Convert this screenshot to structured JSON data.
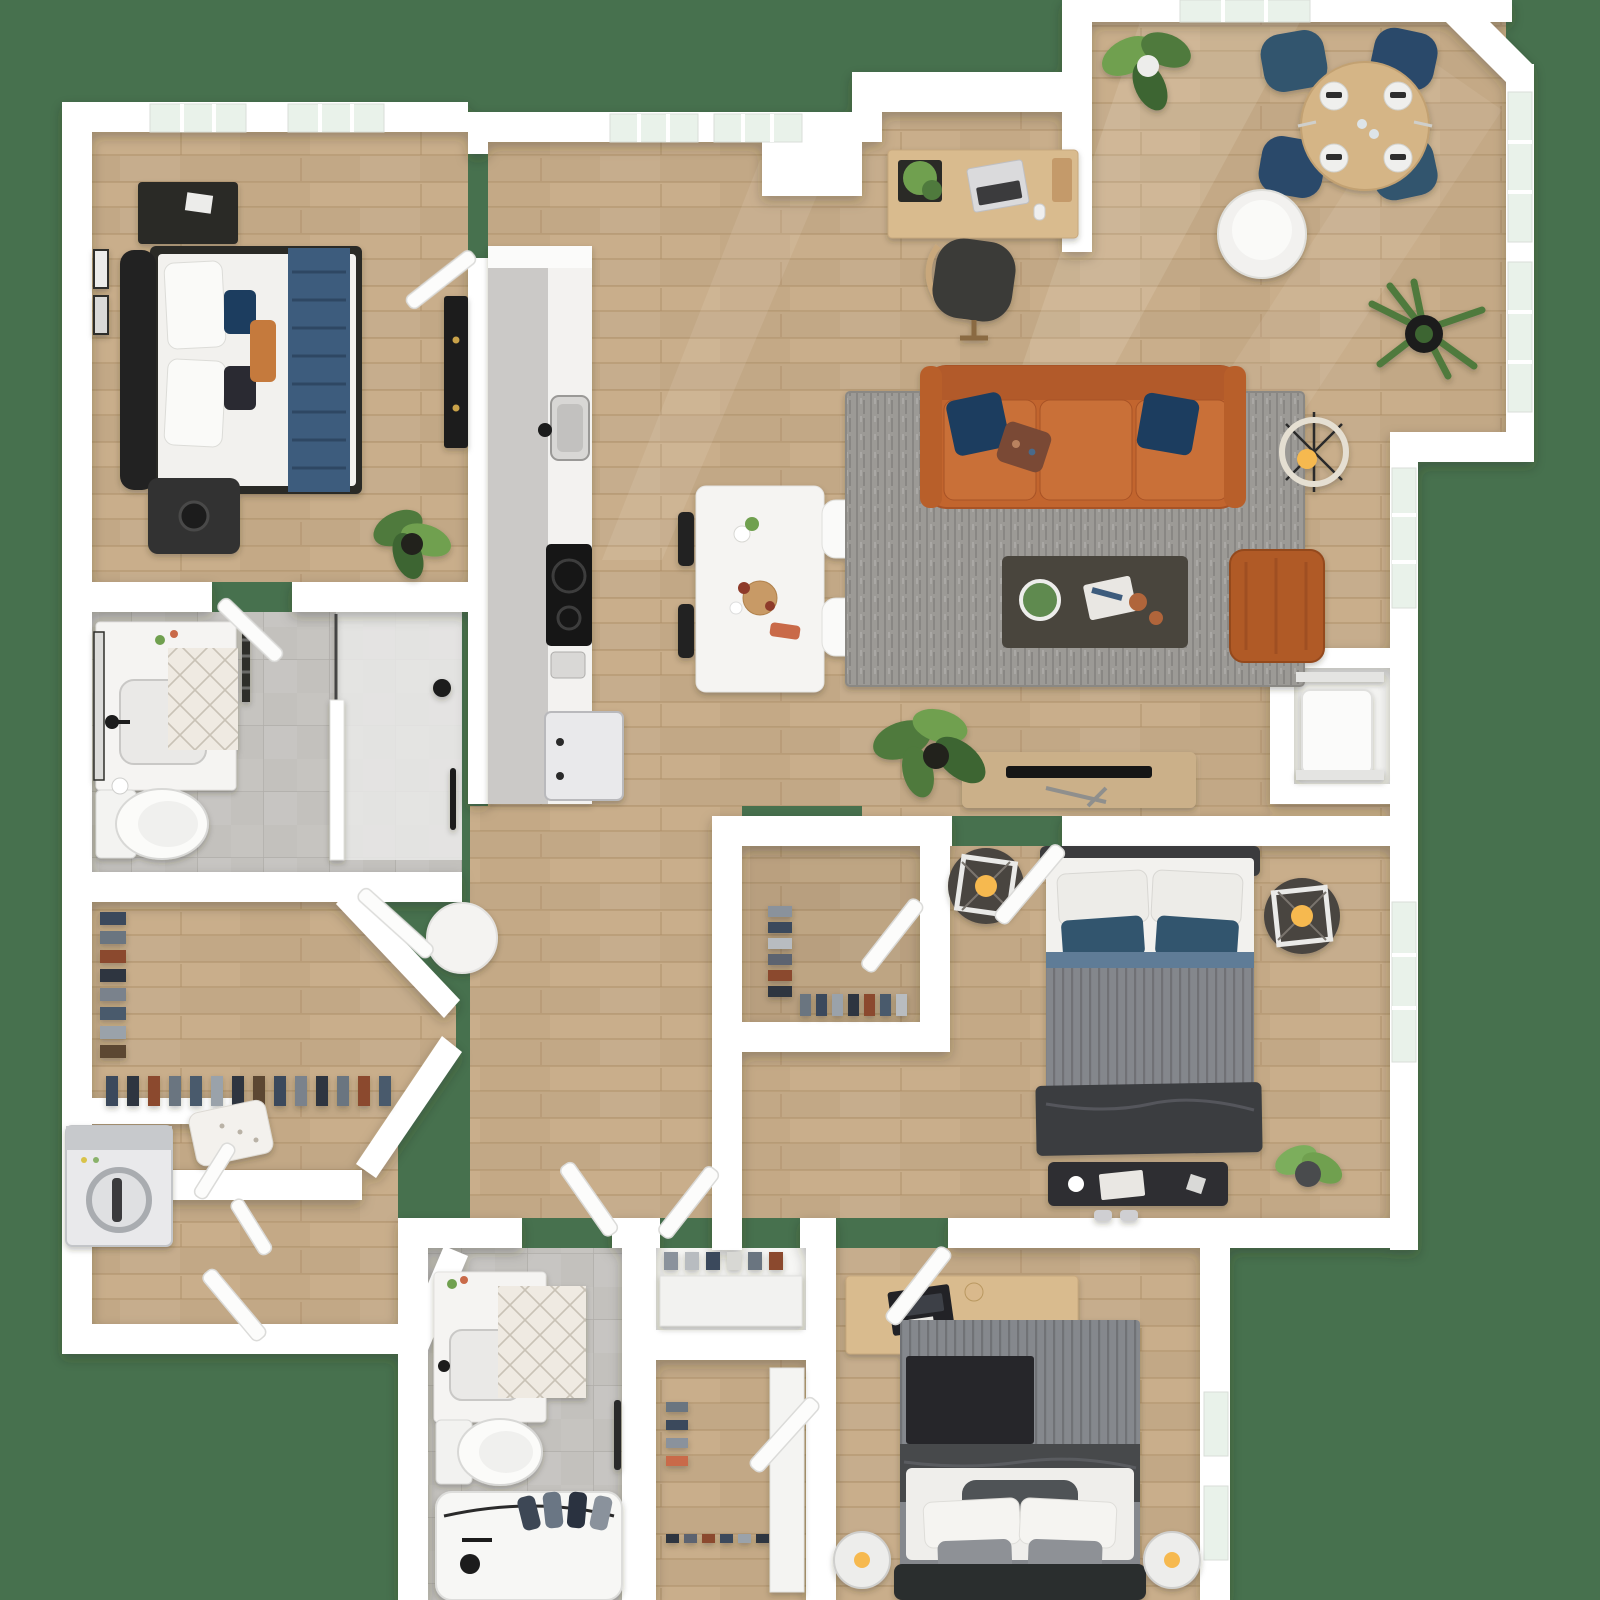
{
  "title": "3D top-down apartment floor plan rendering",
  "palette": {
    "bg": "#47714E",
    "wall": "#FFFFFF",
    "wall-shade": "#E4E4E6",
    "wood": "#C9AE8B",
    "wood-line": "#AE8F69",
    "tile": "#C3C1BD",
    "tile-line": "#A9A6A1",
    "counter": "#CBC9C7",
    "marble": "#F3F2F0",
    "glass": "#E9F2EA",
    "sofa": "#C2652F",
    "sofa-dark": "#A85225",
    "sofa-cushion": "#C97038",
    "navy": "#1C3C5E",
    "navy-light": "#33546E",
    "rug": "#9C9A96",
    "table-dark": "#4A443E",
    "accent-chair": "#B05A28",
    "wood-furn": "#D9BB8E",
    "wood-furn-2": "#CBB089",
    "white-furn": "#F5F4F2",
    "appliance": "#E9E9EB",
    "appliance-dark": "#C7C9CC",
    "black": "#1A1A1A",
    "charcoal": "#2E2F31",
    "dark-frame": "#2B2A28",
    "bed-white": "#F2F1EE",
    "bed2-gray": "#84878C",
    "bed3-gray": "#85888D",
    "blanket-dark": "#3A3C40",
    "throw-black": "#26272A",
    "runner-navy": "#3E5B7D",
    "plant": "#4F7A3C",
    "plant-light": "#6FA04F",
    "pot": "#20211F",
    "glow": "#F6B950",
    "mat": "#EFEAE2",
    "mat-line": "#C9C2B6"
  },
  "scene": {
    "type": "floor-plan",
    "view": "top-down-3d-render",
    "labels_visible": false,
    "rooms": [
      {
        "name": "bedroom-1",
        "floor": "wood",
        "items": [
          "queen-bed",
          "navy-throw",
          "white-pillows",
          "dark-dresser",
          "speaker-nightstand",
          "wall-art",
          "black-media-cabinet",
          "floor-plant",
          "two-windows"
        ]
      },
      {
        "name": "master-bathroom",
        "floor": "tile",
        "items": [
          "vanity-sink",
          "mirror",
          "towel-rack",
          "toilet",
          "diamond-bath-mat",
          "walk-in-shower"
        ]
      },
      {
        "name": "walk-in-closet",
        "floor": "wood",
        "items": [
          "hanging-clothes",
          "shoe-row",
          "upholstered-bench"
        ]
      },
      {
        "name": "laundry-closet",
        "floor": "wood",
        "items": [
          "washer-dryer",
          "bifold-doors"
        ]
      },
      {
        "name": "entry-hall",
        "floor": "wood",
        "items": [
          "entry-door",
          "round-side-table"
        ]
      },
      {
        "name": "kitchen",
        "floor": "wood",
        "items": [
          "counter-run",
          "sink",
          "cooktop",
          "toaster",
          "refrigerator",
          "white-island",
          "bar-stools"
        ]
      },
      {
        "name": "living-room",
        "floor": "wood",
        "items": [
          "leather-sofa",
          "navy-throw-pillows",
          "patterned-pillow",
          "gray-area-rug",
          "dark-coffee-table",
          "orange-accent-chair",
          "ring-floor-lamp",
          "tv-console",
          "flat-tv",
          "floor-plants"
        ]
      },
      {
        "name": "dining-area",
        "floor": "wood",
        "items": [
          "round-dining-table",
          "four-place-settings",
          "four-navy-chairs",
          "white-cylinder-table",
          "palm-plant",
          "potted-plant",
          "corner-windows"
        ]
      },
      {
        "name": "office-nook",
        "floor": "wood",
        "items": [
          "wood-desk",
          "laptop",
          "mouse",
          "desk-plant",
          "office-chair"
        ]
      },
      {
        "name": "storage-closet",
        "floor": "white",
        "items": [
          "water-heater"
        ]
      },
      {
        "name": "bedroom-2",
        "floor": "wood",
        "items": [
          "queen-bed-gray",
          "navy-pillows",
          "round-nightstands",
          "square-lamps",
          "storage-bench",
          "slippers",
          "potted-plant",
          "closet-with-clothes"
        ]
      },
      {
        "name": "bathroom-2",
        "floor": "tile",
        "items": [
          "vanity-sink",
          "toilet",
          "bathtub",
          "draped-towels",
          "diamond-bath-mat"
        ]
      },
      {
        "name": "linen-closet",
        "floor": "white",
        "items": [
          "shelf-items"
        ]
      },
      {
        "name": "bedroom-3-closet",
        "floor": "wood",
        "items": [
          "shoe-shelf",
          "hanging-clothes"
        ]
      },
      {
        "name": "bedroom-3",
        "floor": "wood",
        "items": [
          "bed-striped-duvet",
          "black-throw",
          "wood-desk",
          "laptop",
          "candle",
          "cylinder-table-lamps",
          "side-windows"
        ]
      }
    ]
  }
}
